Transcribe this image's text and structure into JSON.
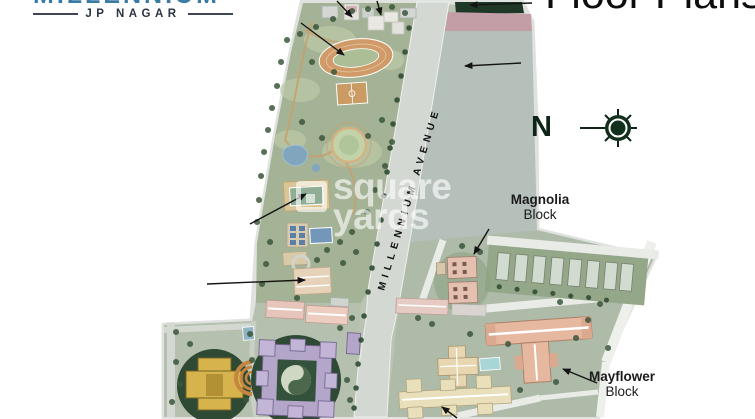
{
  "header": {
    "logo": {
      "brand": "MILLENNIUM",
      "subtitle": "JP NAGAR",
      "brand_color": "#3a7ba6"
    },
    "title": "Floor Plans"
  },
  "compass": {
    "north_label": "N"
  },
  "site_plan": {
    "road_label": "MILLENNIUM AVENUE",
    "labels": {
      "magnolia": {
        "name": "Magnolia",
        "type": "Block"
      },
      "mayflower": {
        "name": "Mayflower",
        "type": "Block"
      }
    }
  },
  "watermark": {
    "line1": "square",
    "line2": "yards"
  },
  "palette": {
    "map_base": "#b9c4b2",
    "park_green": "#a3b394",
    "road_gray": "#d3d8d2",
    "water_gray": "#b4c0bb",
    "dark_green_block": "#1d3826",
    "pink_band": "#c69da7",
    "yellow_block": "#d9b344",
    "lavender_block": "#b4a6cb",
    "salmon_block": "#e9b79c",
    "cream_block": "#ebdfb8",
    "courtyard_circle_green": "#2c4a33",
    "callout_arrow": "#141414"
  }
}
